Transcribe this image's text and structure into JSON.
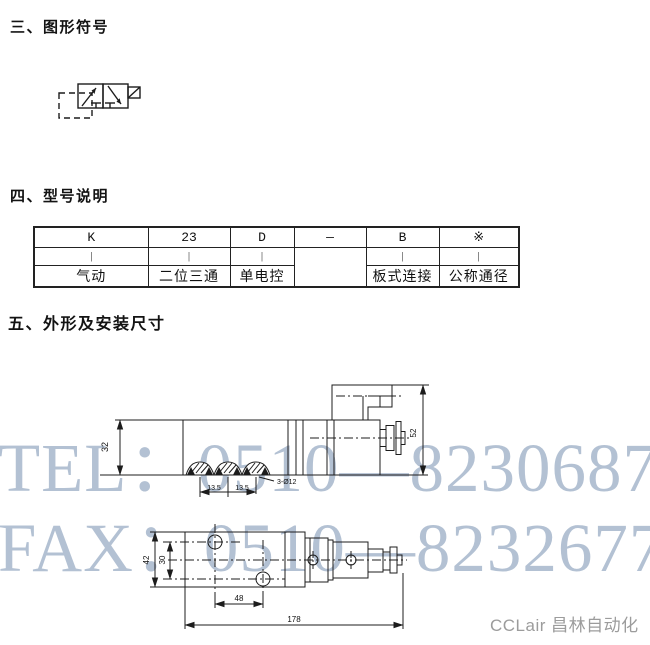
{
  "sections": {
    "graphic_symbol": "三、图形符号",
    "model_description": "四、型号说明",
    "outline_dimensions": "五、外形及安装尺寸"
  },
  "model_table": {
    "row1": [
      "K",
      "23",
      "D",
      "—",
      "B",
      "※"
    ],
    "row2": [
      "|",
      "|",
      "|",
      "|",
      "|"
    ],
    "row3": [
      "气动",
      "二位三通",
      "单电控",
      "板式连接",
      "公称通径"
    ]
  },
  "side_view": {
    "body_height": "32",
    "overall_height": "52",
    "port_pitch_left": "13.5",
    "port_pitch_right": "13.5",
    "port_note": "3-Ø12"
  },
  "top_view": {
    "body_width": "42",
    "hole_pitch_width": "30",
    "hole_pitch_length": "48",
    "overall_length": "178"
  },
  "watermark": {
    "line1": "TEL：0510—82306871",
    "line2": "FAX：0510—82326771",
    "color": "#b3c1d3"
  },
  "footer": {
    "brand": "CCLair 昌林自动化",
    "color": "#9c9c9c"
  }
}
